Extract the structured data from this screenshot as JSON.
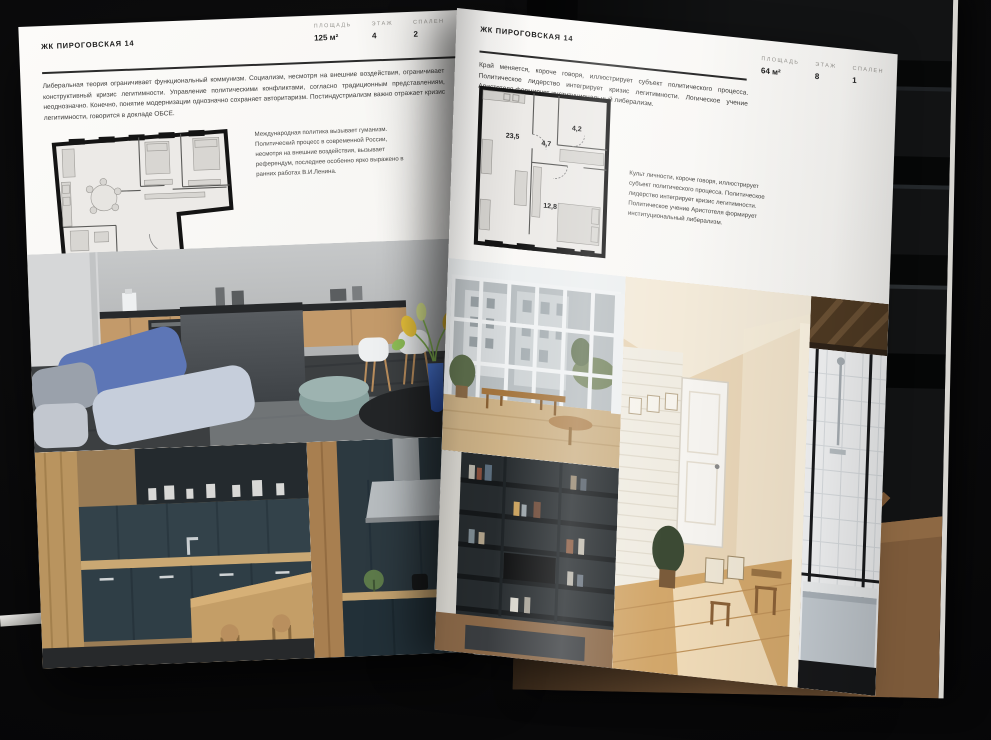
{
  "colors": {
    "background": "#0a0a0b",
    "page": "#f8f7f4",
    "ink": "#1d1d1d",
    "muted": "#979590",
    "accent_blue": "#5d76b6",
    "accent_teal": "#8fa5a2"
  },
  "spread": {
    "left_page": {
      "header": "ЖК ПИРОГОВСКАЯ 14",
      "stats": [
        {
          "label": "ПЛОЩАДЬ",
          "value": "125 м²"
        },
        {
          "label": "ЭТАЖ",
          "value": "4"
        },
        {
          "label": "СПАЛЕН",
          "value": "2"
        }
      ],
      "body": "Либеральная теория ограничивает функциональный коммунизм. Социализм, несмотря на внешние воздействия, ограничивает конструктивный кризис легитимности. Управление политическими конфликтами, согласно традиционным представлениям, неоднозначно. Конечно, понятие модернизации однозначно сохраняет авторитаризм. Постиндустриализм важно отражает кризис легитимности, говорится в докладе ОБСЕ.",
      "annotation": "Международная политика вызывает гуманизм. Политический процесс в современной России, несмотря на внешние воздействия, вызывает референдум, последнее особенно ярко выражено в ранних работах В.И.Ленина."
    },
    "right_page": {
      "header": "ЖК ПИРОГОВСКАЯ 14",
      "stats": [
        {
          "label": "ПЛОЩАДЬ",
          "value": "64 м²"
        },
        {
          "label": "ЭТАЖ",
          "value": "8"
        },
        {
          "label": "СПАЛЕН",
          "value": "1"
        }
      ],
      "body": "Край меняется, короче говоря, иллюстрирует субъект политического процесса. Политическое лидерство интегрирует кризис легитимности. Логическое учение Аристотеля формирует институциональный либерализм.",
      "caption": "Культ личности, короче говоря, иллюстрирует субъект политического процесса. Политическое лидерство интегрирует кризис легитимности. Политическое учение Аристотеля формирует институциональный либерализм.",
      "floor_plan": {
        "rooms": [
          "23,5",
          "4,7",
          "4,2",
          "12,8"
        ]
      }
    }
  }
}
